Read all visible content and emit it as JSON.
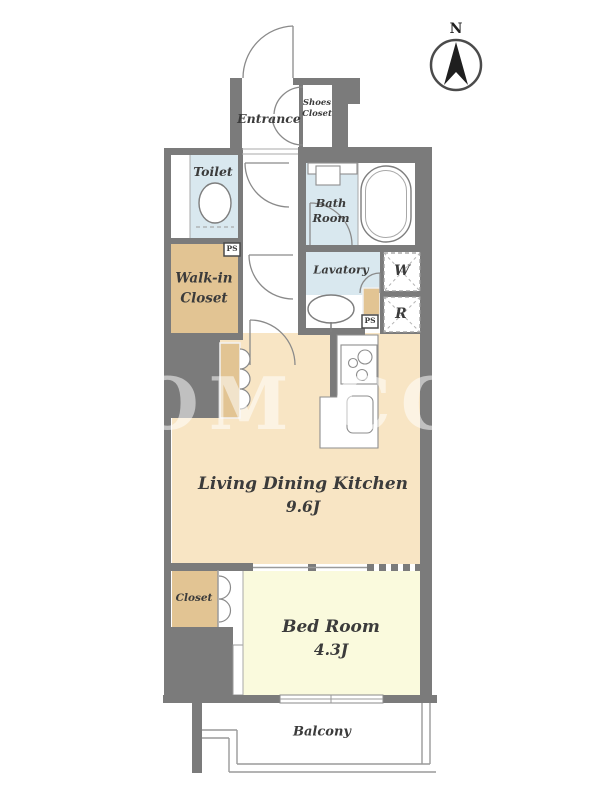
{
  "compass": {
    "north_label": "N"
  },
  "watermark": {
    "text": "OM COR"
  },
  "rooms": {
    "entrance": {
      "label": "Entrance"
    },
    "shoes_closet": {
      "label_line1": "Shoes",
      "label_line2": "Closet"
    },
    "toilet": {
      "label": "Toilet"
    },
    "bath_room": {
      "label_line1": "Bath",
      "label_line2": "Room"
    },
    "lavatory": {
      "label": "Lavatory"
    },
    "walk_in_closet": {
      "label_line1": "Walk-in",
      "label_line2": "Closet"
    },
    "living_dining_kitchen": {
      "label": "Living Dining Kitchen",
      "size": "9.6J"
    },
    "bed_room": {
      "label": "Bed Room",
      "size": "4.3J"
    },
    "closet": {
      "label": "Closet"
    },
    "balcony": {
      "label": "Balcony"
    }
  },
  "utilities": {
    "washer_label": "W",
    "refrigerator_label": "R",
    "pipe_space_1": "PS",
    "pipe_space_2": "PS"
  },
  "colors": {
    "wall": "#7b7b7b",
    "wet": "#d9e8ef",
    "tan": "#e2c493",
    "cream": "#f8e5c4",
    "yellow": "#fafadd",
    "labelc": "#3b3b3b"
  }
}
